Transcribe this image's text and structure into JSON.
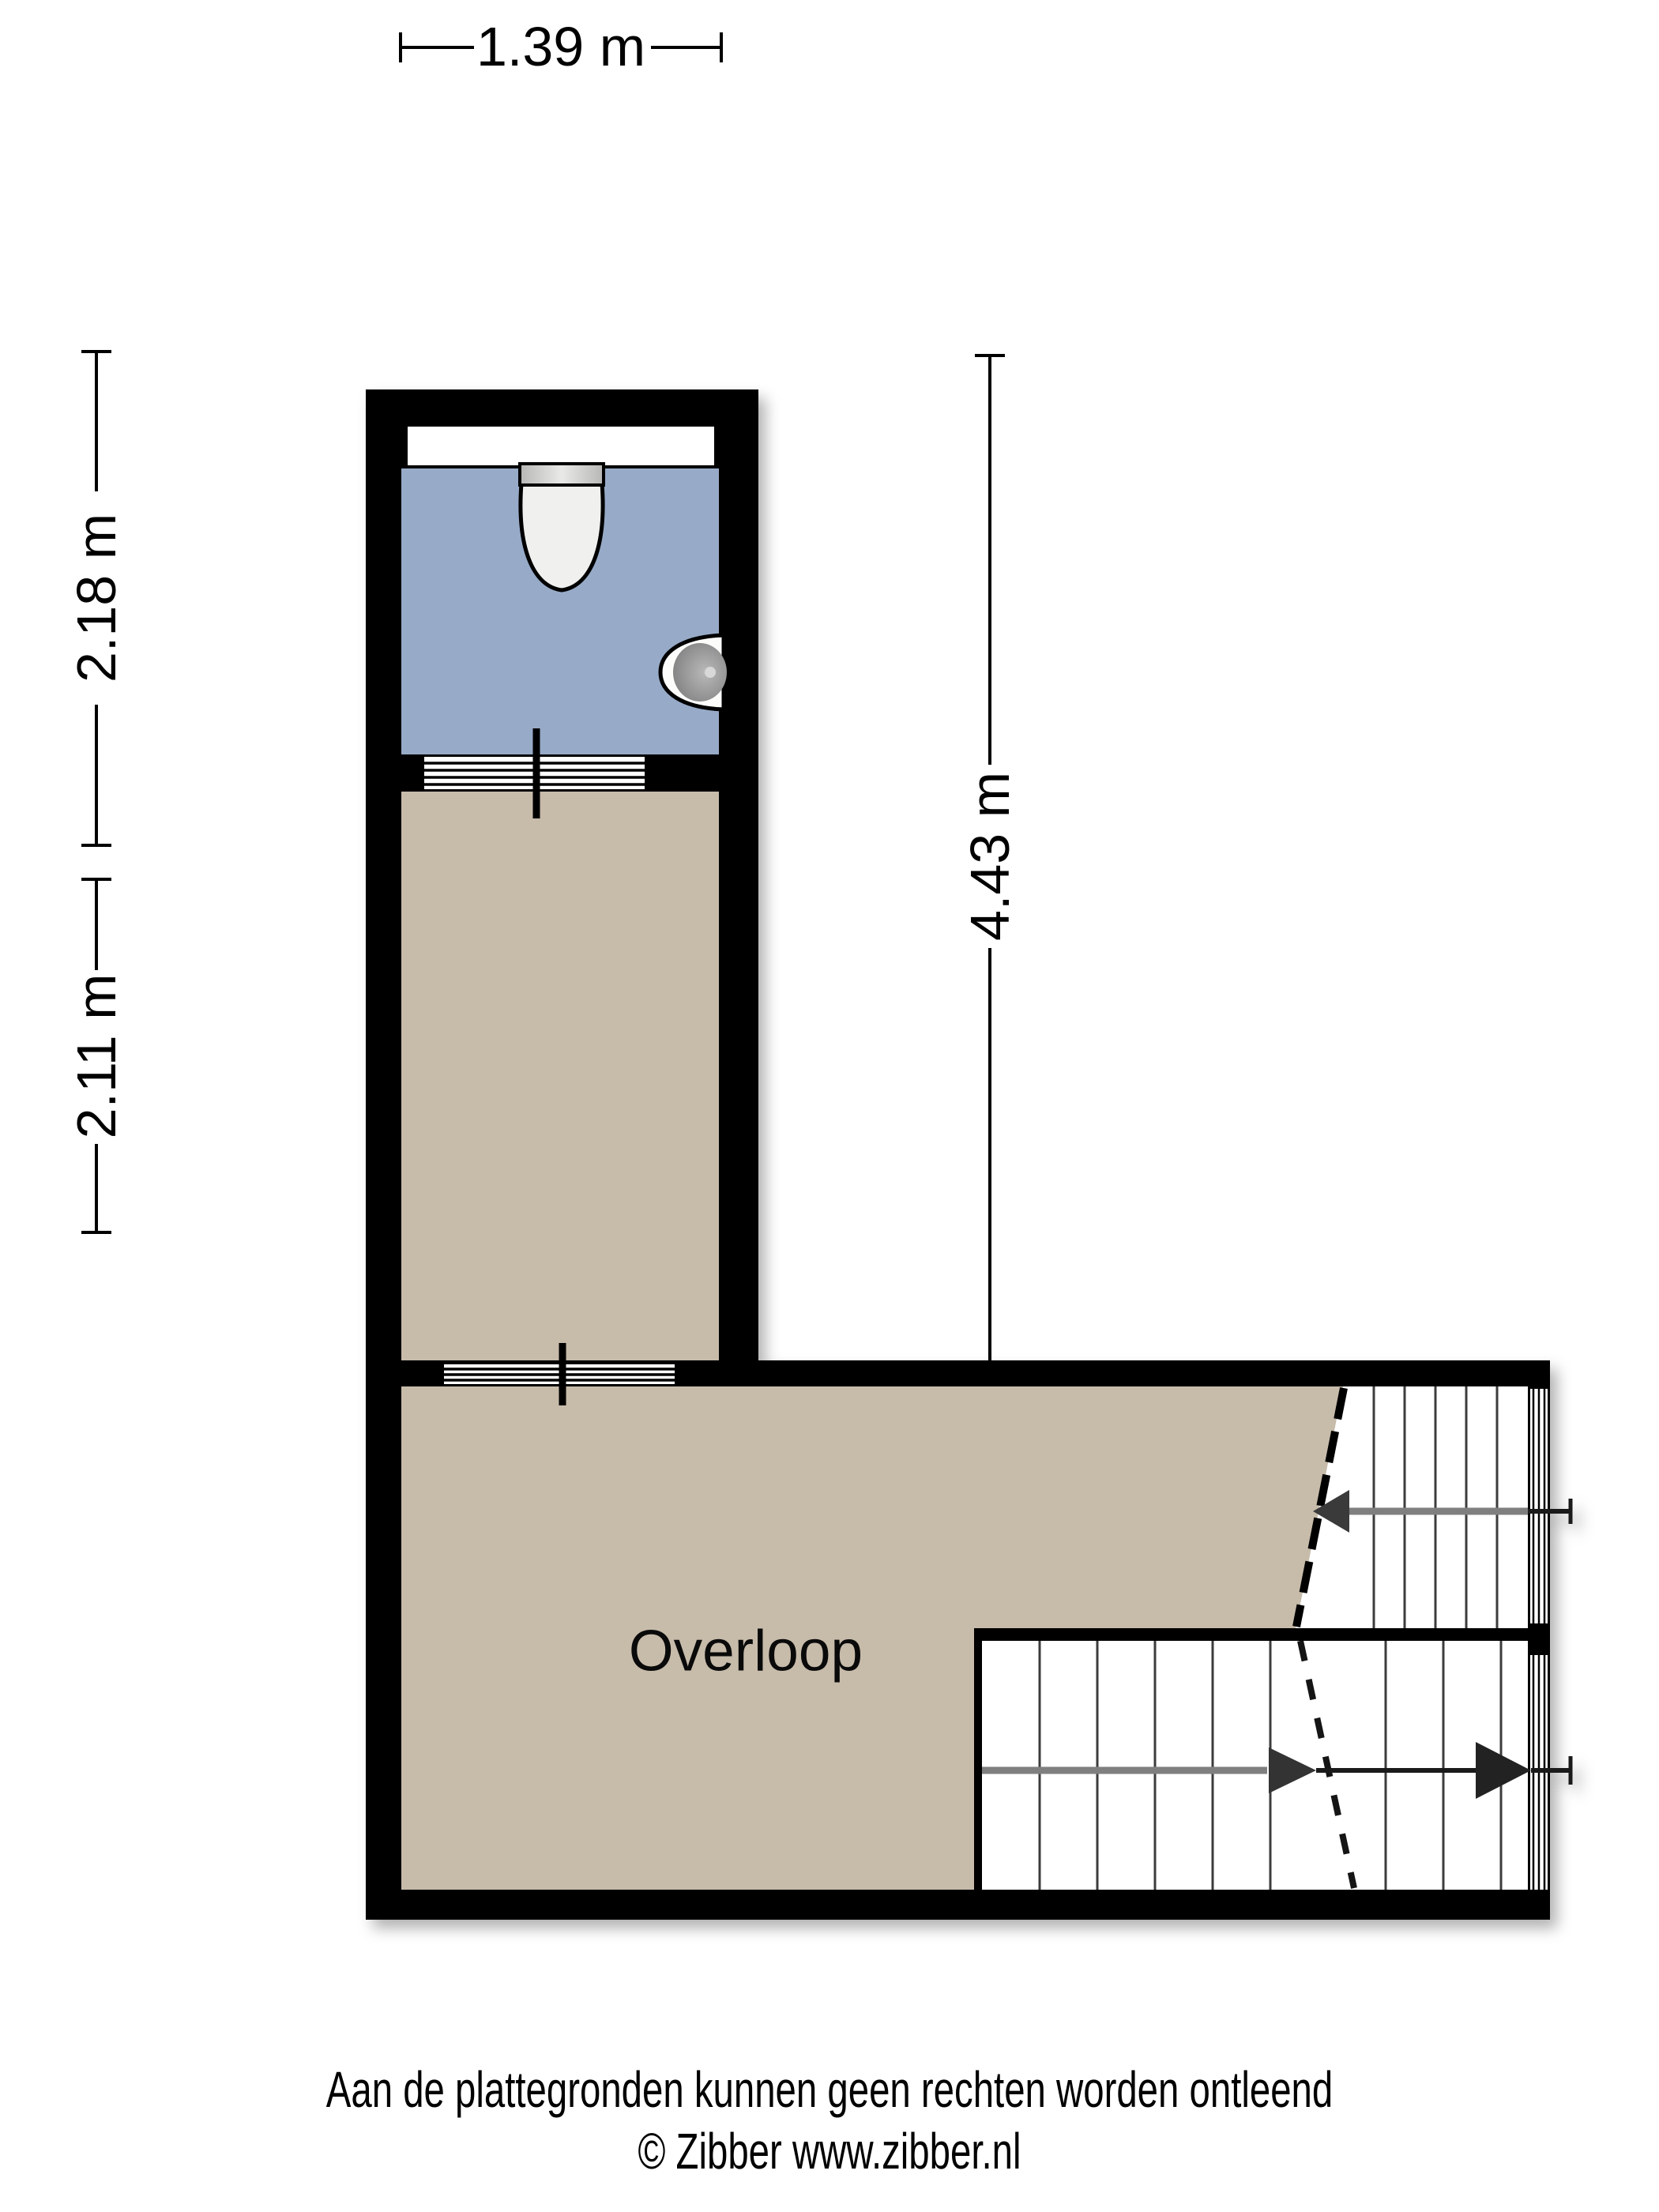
{
  "floorplan": {
    "room": {
      "label": "Overloop"
    },
    "dimensions": {
      "width_top": "1.39 m",
      "toilet_height": "2.18 m",
      "hall_height": "2.11 m",
      "total_height": "4.43 m"
    },
    "colors": {
      "wall": "#000000",
      "toilet_floor": "#97abc8",
      "landing_floor": "#c7bbaa",
      "stair_arrow_gray": "#7f7f7f",
      "arrowhead_dark": "#333333"
    },
    "icons": {
      "toilet": "toilet-icon",
      "sink": "sink-icon",
      "stairs_up": "stairs-up-flight",
      "stairs_down": "stairs-down-flight"
    }
  },
  "footer": {
    "disclaimer": "Aan de plattegronden kunnen geen rechten worden ontleend",
    "copyright": "© Zibber www.zibber.nl"
  }
}
